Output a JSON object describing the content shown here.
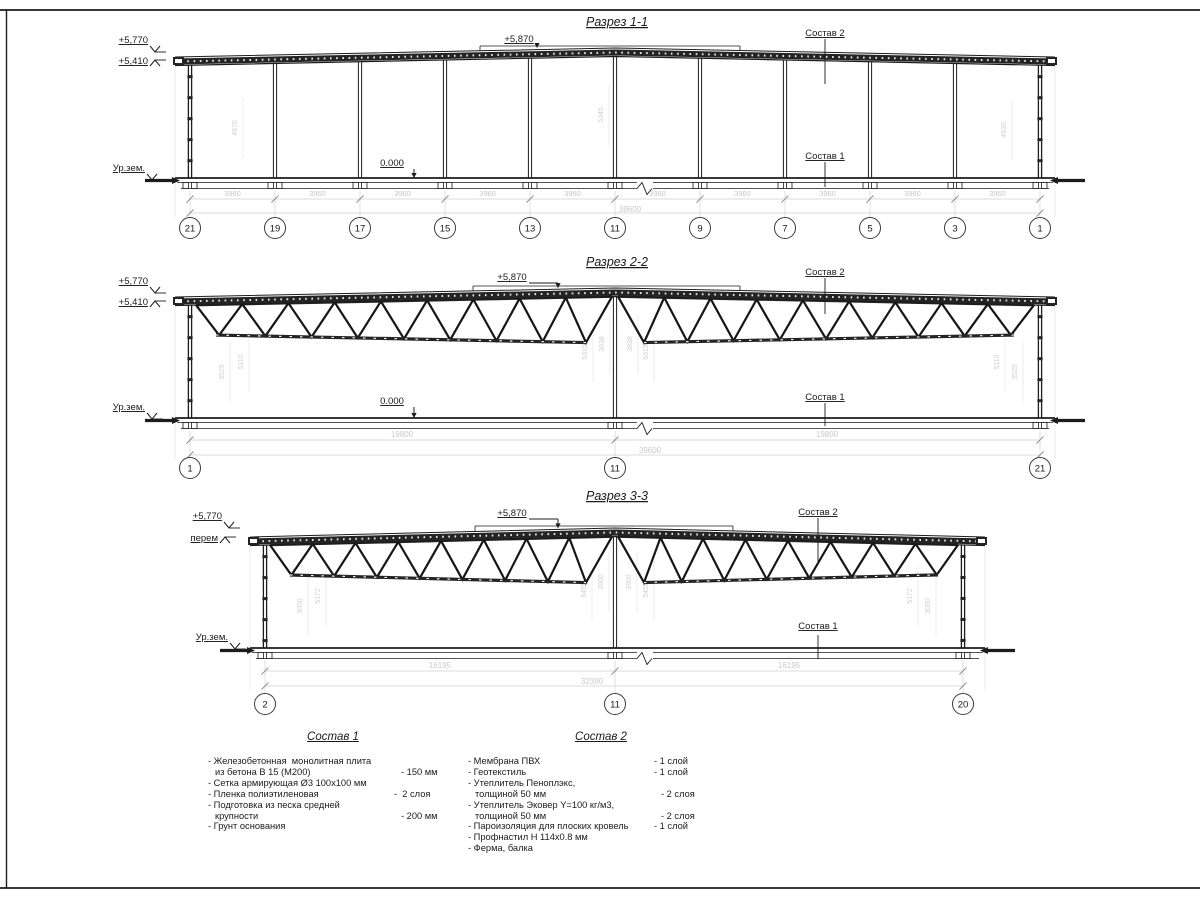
{
  "sections": [
    {
      "title": "Разрез 1-1",
      "elev_top": "+5,770",
      "elev_eave": "+5,410",
      "elev_ridge": "+5,870",
      "ground_label": "Ур.зем.",
      "zero_label": "0.000",
      "layer_top_label": "Состав 2",
      "layer_bottom_label": "Состав 1",
      "bay_dim": "3960",
      "bay_count": 10,
      "total_dim": "39600",
      "grid_bubbles": [
        "21",
        "19",
        "17",
        "15",
        "13",
        "11",
        "9",
        "7",
        "5",
        "3",
        "1"
      ],
      "interior_dims": [
        "4970",
        "5345",
        "4930"
      ]
    },
    {
      "title": "Разрез 2-2",
      "elev_top": "+5,770",
      "elev_eave": "+5,410",
      "elev_ridge": "+5,870",
      "ground_label": "Ур.зем.",
      "zero_label": "0.000",
      "layer_top_label": "Состав 2",
      "layer_bottom_label": "Состав 1",
      "half_dims": [
        "19800",
        "19800"
      ],
      "total_dim": "39600",
      "grid_bubbles": [
        "1",
        "11",
        "21"
      ],
      "interior_dims": [
        "3529",
        "5110",
        "5315",
        "3838",
        "3838",
        "5315",
        "5110",
        "3529"
      ]
    },
    {
      "title": "Разрез 3-3",
      "elev_top": "+5,770",
      "elev_var": "перем",
      "elev_ridge": "+5,870",
      "ground_label": "Ур.зем.",
      "layer_top_label": "Состав 2",
      "layer_bottom_label": "Состав 1",
      "half_dims": [
        "16195",
        "16195"
      ],
      "total_dim": "32390",
      "grid_bubbles": [
        "2",
        "11",
        "20"
      ],
      "interior_dims": [
        "3050",
        "5172",
        "5455",
        "3900",
        "3900",
        "5455",
        "5172",
        "3050"
      ]
    }
  ],
  "legend": {
    "comp1": {
      "title": "Состав 1",
      "lines": [
        {
          "t": "- Железобетонная  монолитная плита",
          "q": "",
          "ind": false
        },
        {
          "t": "из бетона В 15 (М200)",
          "q": "- 150 мм",
          "ind": true
        },
        {
          "t": "- Сетка армирующая Ø3 100x100 мм",
          "q": "",
          "ind": false
        },
        {
          "t": "- Пленка полиэтиленовая",
          "q": "-  2 слоя",
          "ind": false
        },
        {
          "t": "- Подготовка из песка средней",
          "q": "",
          "ind": false
        },
        {
          "t": "крупности",
          "q": "- 200 мм",
          "ind": true
        },
        {
          "t": "- Грунт основания",
          "q": "",
          "ind": false
        }
      ]
    },
    "comp2": {
      "title": "Состав 2",
      "lines": [
        {
          "t": "- Мембрана ПВХ",
          "q": "- 1 слой",
          "ind": false
        },
        {
          "t": "- Геотекстиль",
          "q": "- 1 слой",
          "ind": false
        },
        {
          "t": "- Утеплитель Пеноплэкс,",
          "q": "",
          "ind": false
        },
        {
          "t": "толщиной 50 мм",
          "q": "- 2 слоя",
          "ind": true
        },
        {
          "t": "- Утеплитель Эковер Y=100 кг/м3,",
          "q": "",
          "ind": false
        },
        {
          "t": "толщиной 50 мм",
          "q": "- 2 слоя",
          "ind": true
        },
        {
          "t": "- Пароизоляция для плоских кровель",
          "q": "- 1 слой",
          "ind": false
        },
        {
          "t": "- Профнастил Н 114x0.8 мм",
          "q": "",
          "ind": false
        },
        {
          "t": "- Ферма, балка",
          "q": "",
          "ind": false
        }
      ]
    }
  }
}
